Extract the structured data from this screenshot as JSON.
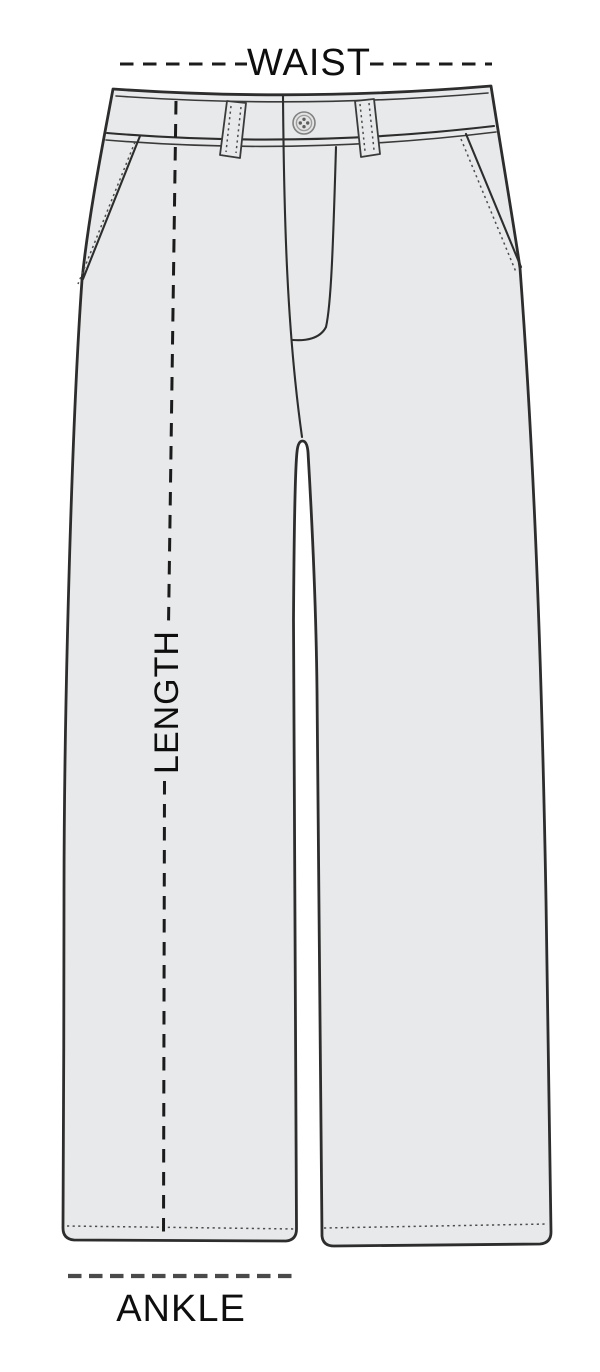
{
  "diagram": {
    "type": "garment-size-guide",
    "garment": "wide-leg-pants-technical-flat",
    "labels": {
      "waist": "WAIST",
      "length": "LENGTH",
      "ankle": "ANKLE"
    },
    "icons": {
      "button": "waist-button-icon"
    },
    "colors": {
      "background": "#ffffff",
      "fabric": "#e8e9ea",
      "outline": "#2d2d2d",
      "seam": "#3a3a3a",
      "stitch": "#4c4c4c",
      "measure": "#1b1b1b",
      "ankle-line": "#4a4a4a",
      "label-text": "#0e0e0e",
      "button-face": "#e3e3e4",
      "button-rim": "#818181",
      "button-hole": "#5f5f5f"
    }
  }
}
